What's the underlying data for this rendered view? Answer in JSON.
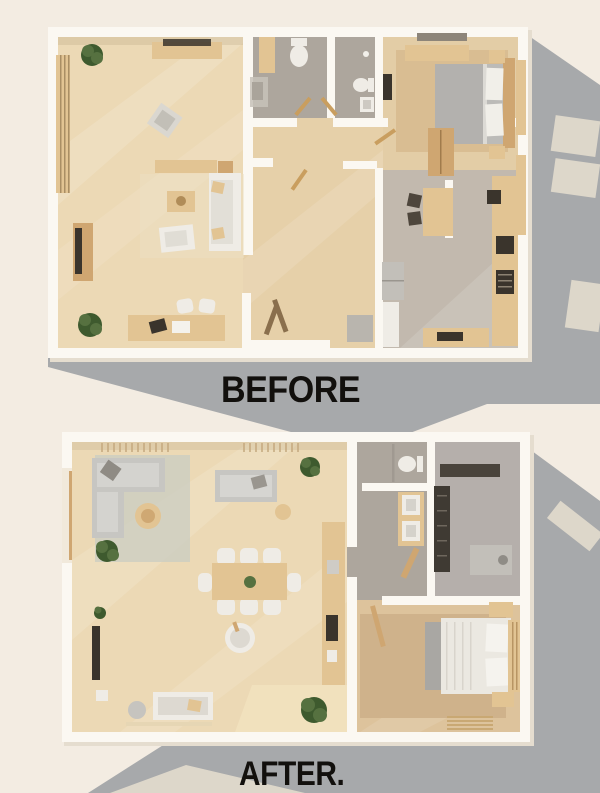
{
  "labels": {
    "before": "BEFORE",
    "after": "AFTER."
  },
  "palette": {
    "bg": "#f3ece2",
    "shadow": "#a7a9ab",
    "lightPatch": "#ece3d2",
    "wall": "#fbf8f2",
    "wallShade": "#e5ddcf",
    "woodLight": "#ecd9b5",
    "wood": "#e3cda6",
    "woodDark": "#ddc39c",
    "woodHall": "#e6d0a9",
    "greyBath": "#ada69d",
    "greyKitchen": "#c2b9ae",
    "greyUtility": "#b5afab",
    "rugTan": "#cfb28b",
    "rugGrey": "#cccdc2",
    "sofaGrey": "#c7c6c2",
    "white": "#efece6",
    "bedGrey": "#bcbbb8",
    "furnWood": "#cfa671",
    "furnWoodLight": "#e2c493",
    "dark": "#3a342c",
    "plant": "#567140",
    "plantDark": "#3e5a2e",
    "appliance": "#c2bfb9",
    "text": "#12100d"
  }
}
